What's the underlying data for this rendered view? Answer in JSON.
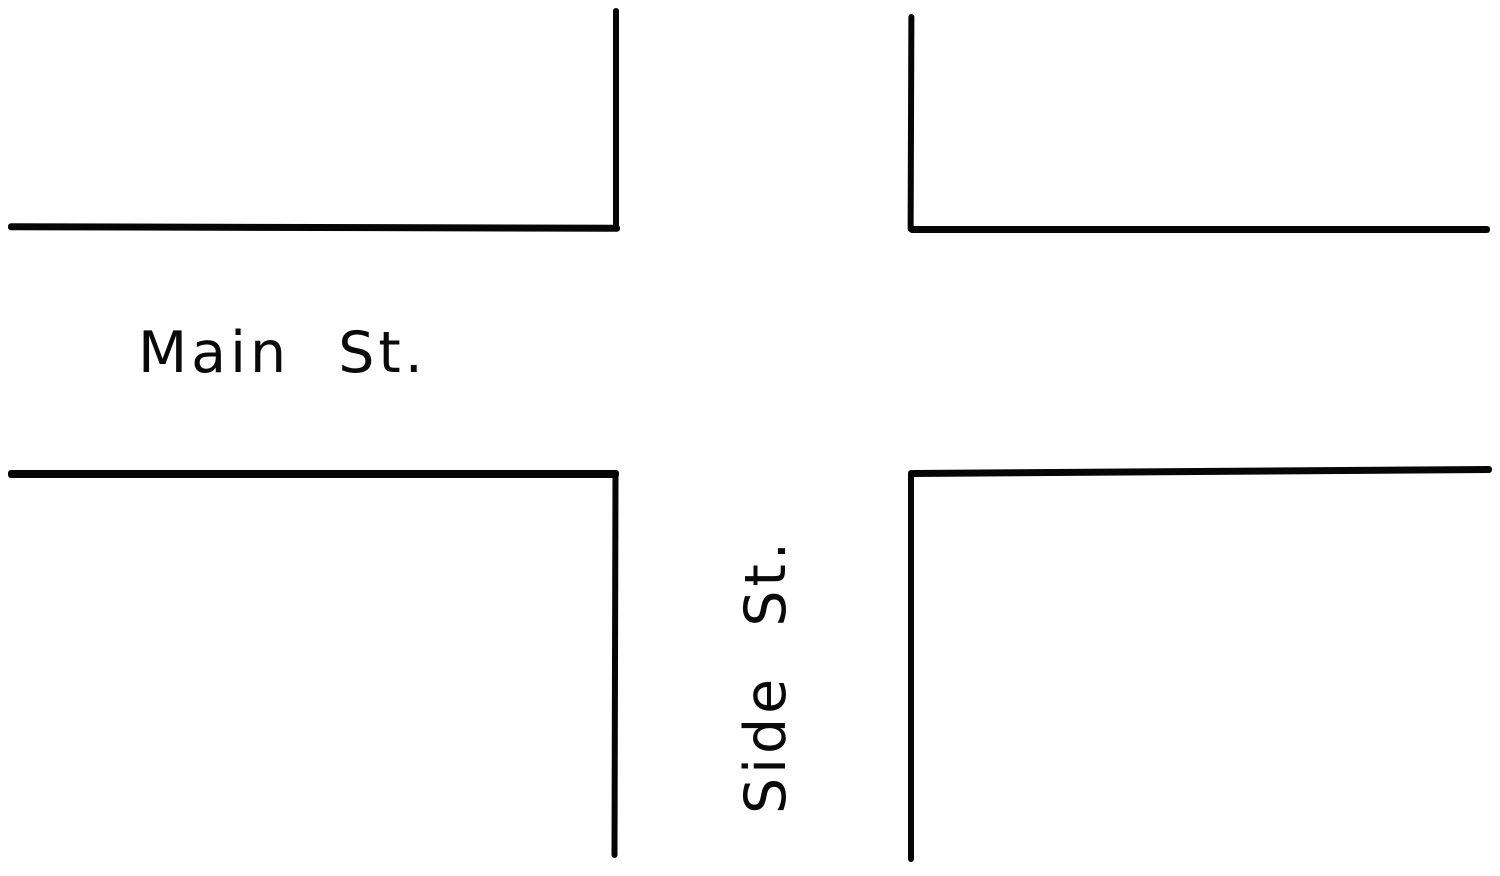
{
  "page": {
    "background_color": "#ffffff",
    "ink_color": "#060606"
  },
  "diagram": {
    "type": "street-intersection-map",
    "description": "Plan-view line drawing of a four-way street intersection",
    "streets": [
      {
        "label": "Main St.",
        "orientation": "horizontal"
      },
      {
        "label": "Side St.",
        "orientation": "vertical"
      }
    ]
  }
}
